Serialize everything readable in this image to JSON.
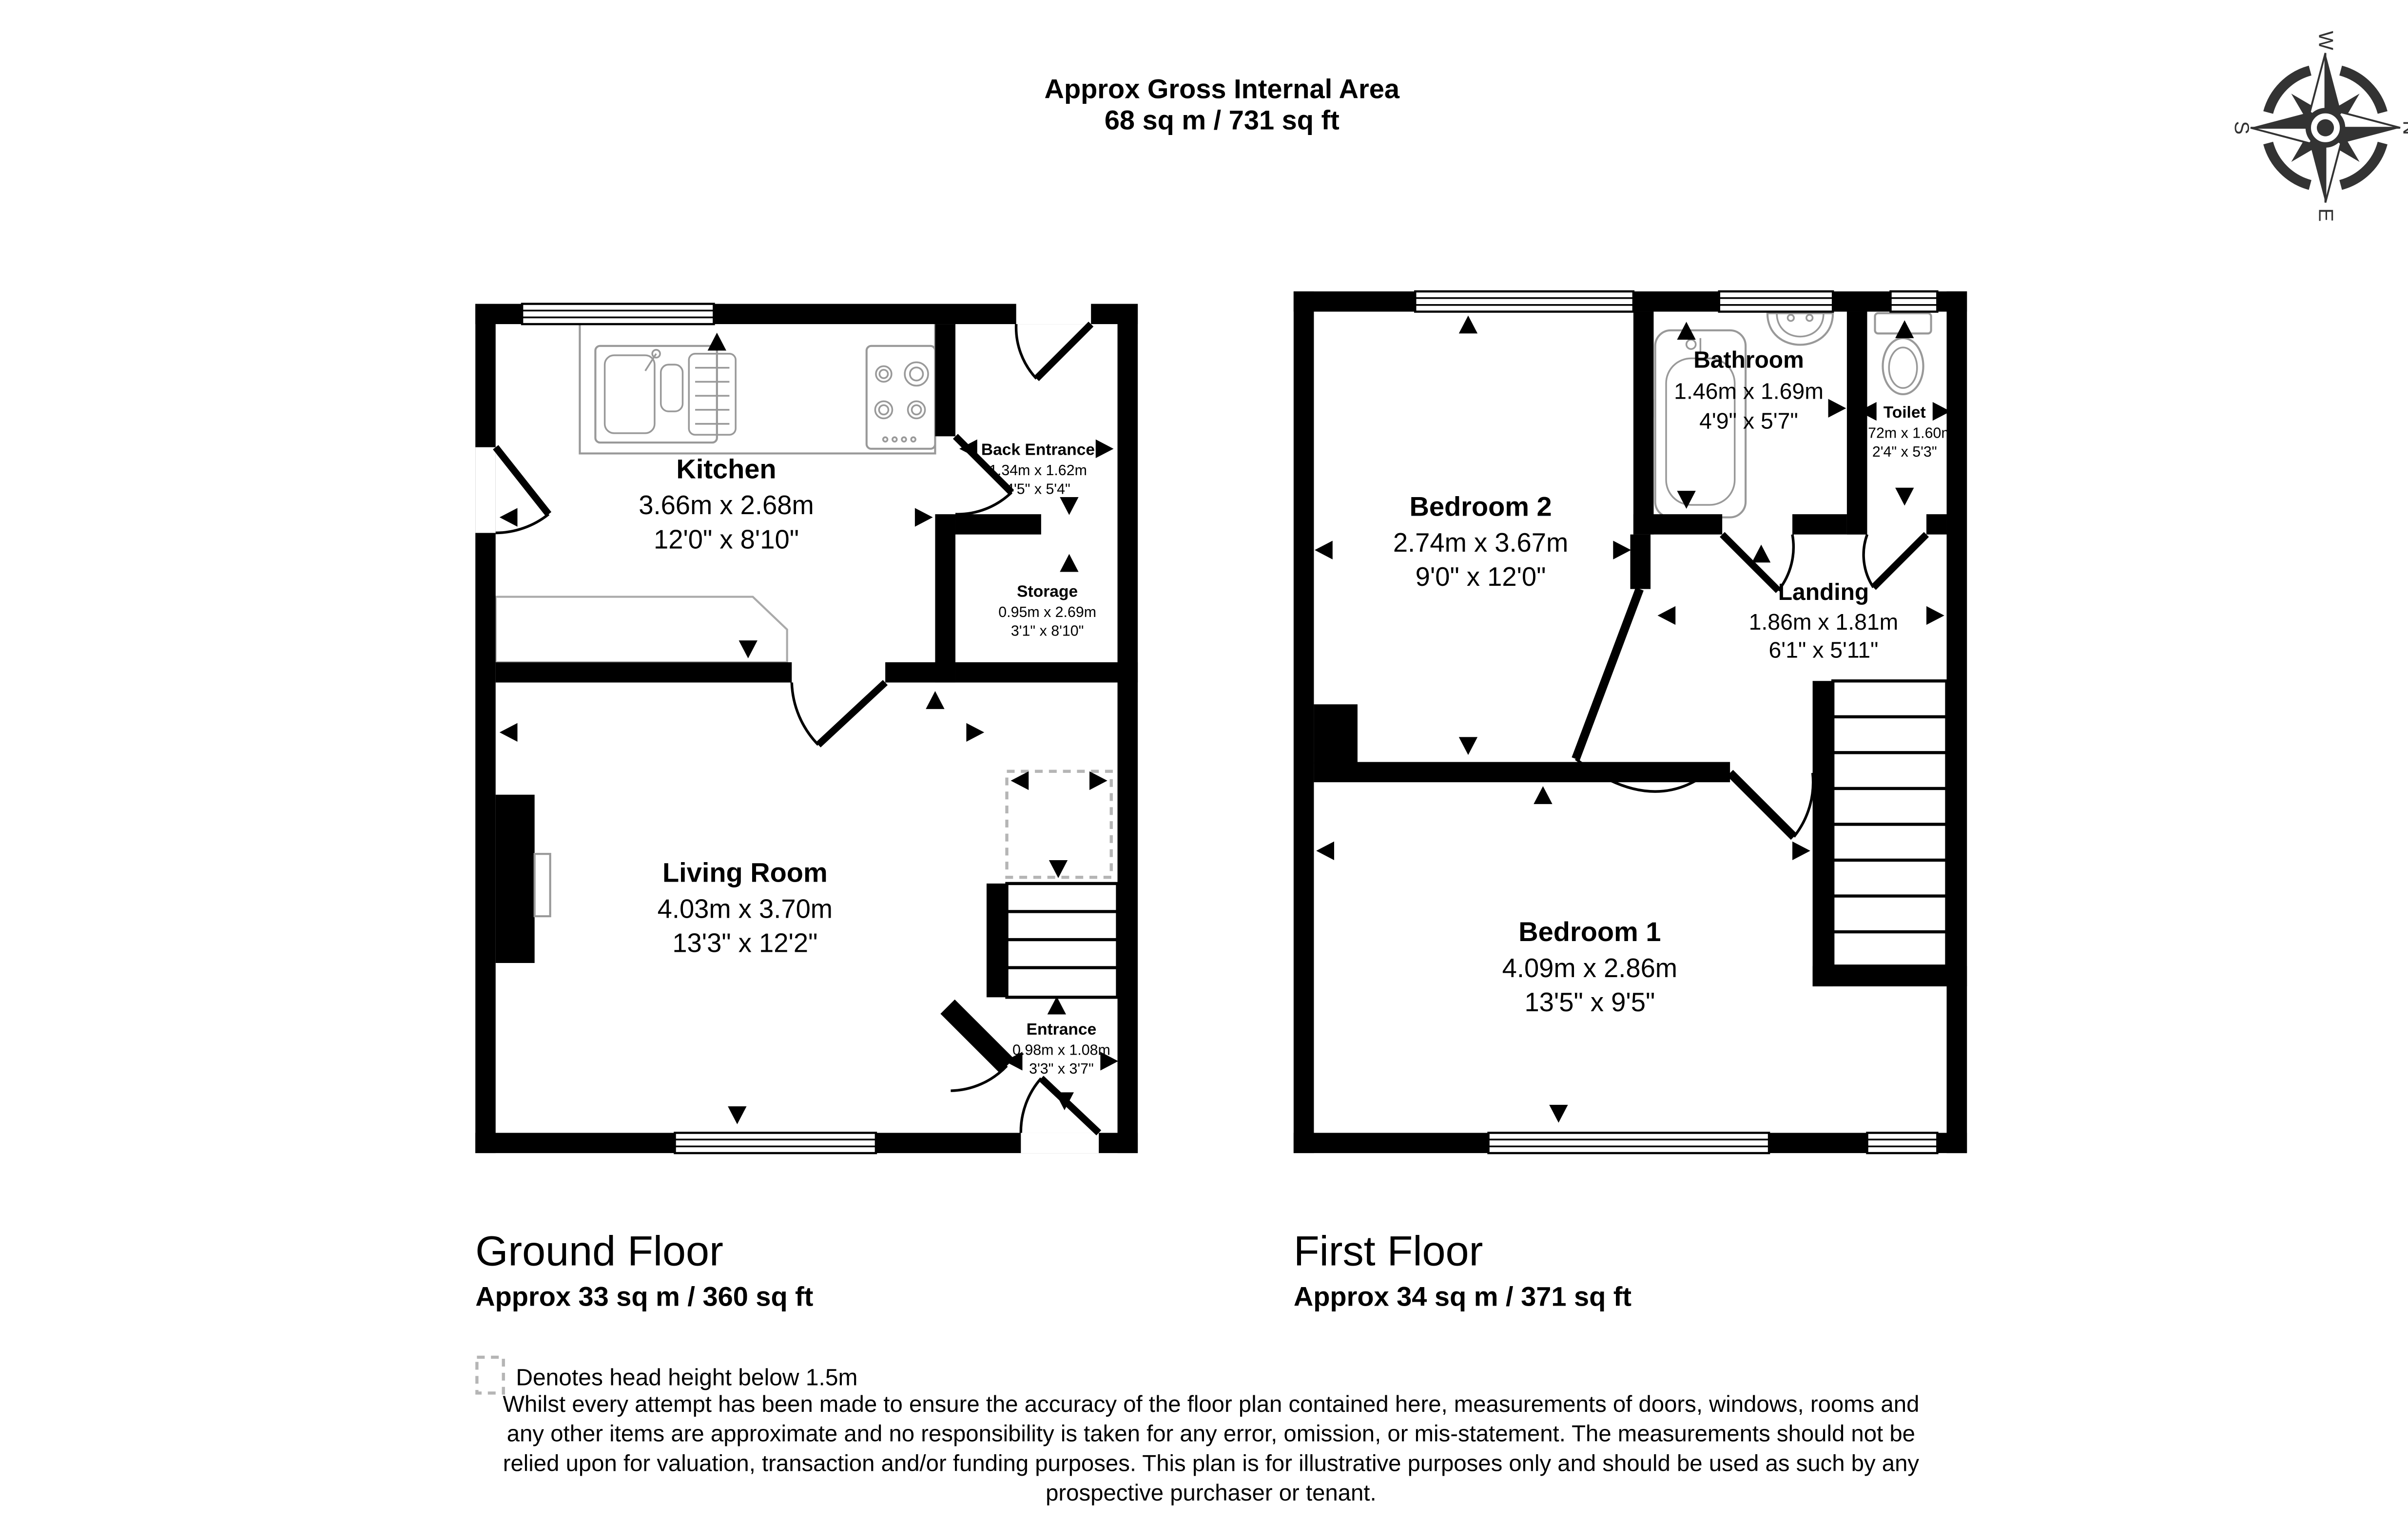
{
  "header": {
    "title": "Approx Gross Internal Area",
    "subtitle": "68 sq m / 731 sq ft"
  },
  "compass": {
    "north": "N",
    "east": "E",
    "south": "S",
    "west": "W"
  },
  "floors": [
    {
      "name": "Ground Floor",
      "area": "Approx 33 sq m / 360 sq ft"
    },
    {
      "name": "First Floor",
      "area": "Approx 34 sq m / 371 sq ft"
    }
  ],
  "rooms": {
    "kitchen": {
      "name": "Kitchen",
      "metric": "3.66m x 2.68m",
      "imperial": "12'0\" x 8'10\""
    },
    "back_entrance": {
      "name": "Back Entrance",
      "metric": "1.34m x 1.62m",
      "imperial": "4'5\" x 5'4\""
    },
    "storage": {
      "name": "Storage",
      "metric": "0.95m x 2.69m",
      "imperial": "3'1\" x 8'10\""
    },
    "living_room": {
      "name": "Living Room",
      "metric": "4.03m x 3.70m",
      "imperial": "13'3\" x 12'2\""
    },
    "entrance": {
      "name": "Entrance",
      "metric": "0.98m x 1.08m",
      "imperial": "3'3\" x 3'7\""
    },
    "bedroom2": {
      "name": "Bedroom 2",
      "metric": "2.74m x 3.67m",
      "imperial": "9'0\" x 12'0\""
    },
    "bathroom": {
      "name": "Bathroom",
      "metric": "1.46m x 1.69m",
      "imperial": "4'9\" x 5'7\""
    },
    "toilet": {
      "name": "Toilet",
      "metric": "0.72m x 1.60m",
      "imperial": "2'4\" x 5'3\""
    },
    "landing": {
      "name": "Landing",
      "metric": "1.86m x 1.81m",
      "imperial": "6'1\" x 5'11\""
    },
    "bedroom1": {
      "name": "Bedroom 1",
      "metric": "4.09m x 2.86m",
      "imperial": "13'5\" x 9'5\""
    }
  },
  "legend": {
    "head_height": "Denotes head height below 1.5m"
  },
  "disclaimer": {
    "lines": [
      "Whilst every attempt has been made to ensure the accuracy of the floor plan contained here, measurements of doors, windows, rooms and",
      "any other items are approximate and no responsibility is taken for any error, omission, or mis-statement. The measurements should not be",
      "relied upon for valuation, transaction and/or funding purposes. This plan is for illustrative purposes only and should be used as such by any",
      "prospective purchaser or tenant."
    ]
  },
  "colors": {
    "wall": "#000000",
    "fixture_stroke": "#999999",
    "dashed_zone": "#b5b5b5"
  }
}
